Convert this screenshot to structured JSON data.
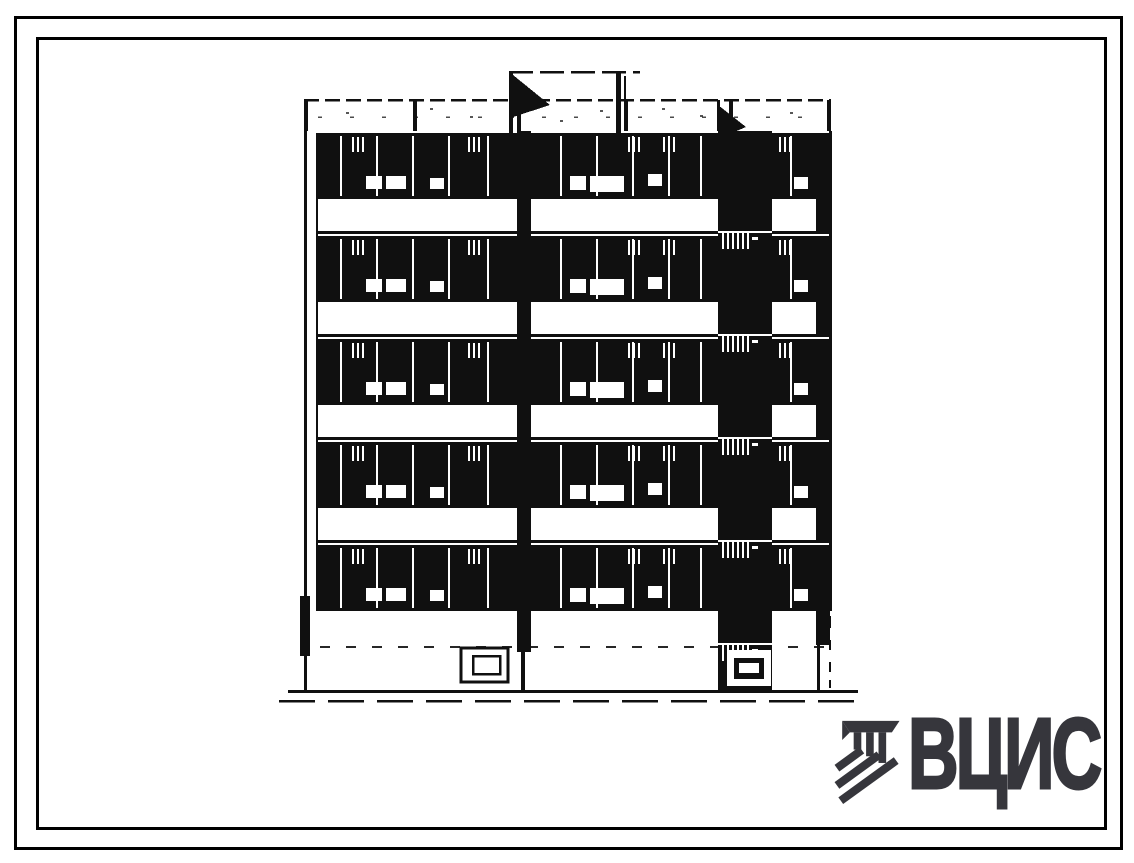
{
  "page": {
    "background": "#ffffff",
    "ink": "#101010"
  },
  "frames": {
    "outer_border_color": "#000000",
    "inner_border_color": "#000000"
  },
  "drawing": {
    "kind": "building-facade-elevation",
    "floors": 5,
    "roof_flags": 2,
    "entrances": 2,
    "stairwell_strips": 1
  },
  "logo": {
    "text": "ВЦИС",
    "color": "#36363c",
    "icon": "vcis-hatched-monogram-icon"
  }
}
